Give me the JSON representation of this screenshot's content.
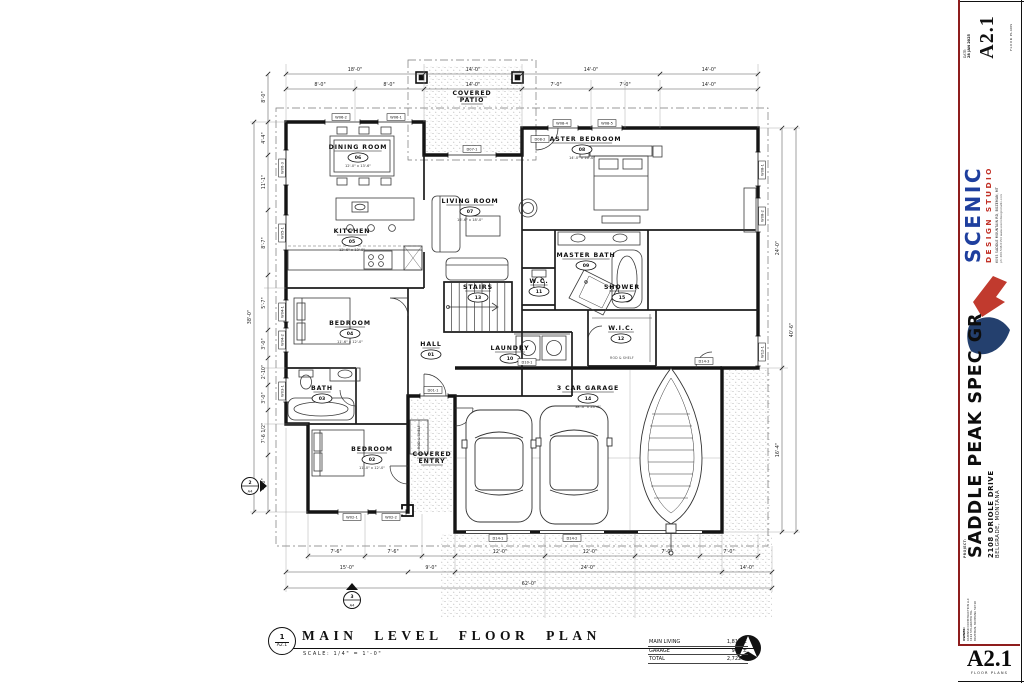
{
  "sheet": {
    "date_label": "DATE:",
    "date": "28 JAN 2025",
    "number": "A2.1",
    "number_caption": "FLOOR PLANS",
    "studio": {
      "name": "SCENIC",
      "tagline": "DESIGN STUDIO",
      "address": "6093 SADDLE MOUNTAIN RD, BOZEMAN, MT",
      "contact": "ph: 406.548.6154   www.scenicdesignstudio.com"
    },
    "project_label": "PROJECT:",
    "project": "SADDLE PEAK SPEC GR",
    "address": "2108 ORIOLE DRIVE",
    "city": "BELGRADE, MONTANA",
    "owner_label": "OWNER:",
    "owner_lines": [
      "KAMINSKI CONSTRUCTION LLC",
      "1114 STILLWATER TRL",
      "BOZEMAN, MONTANA 59718"
    ]
  },
  "title": {
    "detail_number": "1",
    "detail_sheet": "A2.1",
    "name": "MAIN LEVEL FLOOR PLAN",
    "scale": "SCALE:   1/4\" = 1'-0\"",
    "areas": [
      {
        "label": "MAIN LIVING",
        "value": "1,818 ±"
      },
      {
        "label": "GARAGE",
        "value": "904 ±"
      },
      {
        "label": "TOTAL",
        "value": "2,722 ±"
      }
    ]
  },
  "plan": {
    "rooms": [
      {
        "name": "DINING ROOM",
        "tag": "06",
        "dim": "12'-0\" x 13'-6\"",
        "x": 358,
        "y": 149
      },
      {
        "name": "KITCHEN",
        "tag": "05",
        "dim": "12'-6\" x 13'-0\"",
        "x": 352,
        "y": 233
      },
      {
        "name": "LIVING ROOM",
        "tag": "07",
        "dim": "16'-6\" x 18'-0\"",
        "x": 470,
        "y": 203
      },
      {
        "name": "MASTER BEDROOM",
        "tag": "08",
        "dim": "14'-0\" x 16'-0\"",
        "x": 582,
        "y": 141
      },
      {
        "name": "MASTER BATH",
        "tag": "09",
        "dim": "",
        "x": 586,
        "y": 257
      },
      {
        "name": "SHOWER",
        "tag": "15",
        "dim": "",
        "x": 622,
        "y": 289
      },
      {
        "name": "W.C.",
        "tag": "11",
        "dim": "",
        "x": 539,
        "y": 283
      },
      {
        "name": "STAIRS",
        "tag": "13",
        "dim": "",
        "x": 478,
        "y": 289
      },
      {
        "name": "LAUNDRY",
        "tag": "10",
        "dim": "",
        "x": 510,
        "y": 350
      },
      {
        "name": "W.I.C.",
        "tag": "12",
        "dim": "",
        "x": 621,
        "y": 330
      },
      {
        "name": "HALL",
        "tag": "01",
        "dim": "",
        "x": 431,
        "y": 346
      },
      {
        "name": "BEDROOM",
        "tag": "04",
        "dim": "11'-6\" x 12'-0\"",
        "x": 350,
        "y": 325
      },
      {
        "name": "BATH",
        "tag": "03",
        "dim": "",
        "x": 322,
        "y": 390
      },
      {
        "name": "BEDROOM",
        "tag": "02",
        "dim": "11'-0\" x 12'-0\"",
        "x": 372,
        "y": 451
      },
      {
        "name": "3 CAR GARAGE",
        "tag": "14",
        "dim": "38'-0\" x 24'-0\"",
        "x": 588,
        "y": 390
      },
      {
        "name": "COVERED|PATIO",
        "tag": "",
        "dim": "",
        "x": 472,
        "y": 95
      },
      {
        "name": "COVERED|ENTRY",
        "tag": "",
        "dim": "",
        "x": 432,
        "y": 456
      }
    ],
    "wd_tags": [
      {
        "l": "W06-2",
        "x": 341,
        "y": 117,
        "r": 0
      },
      {
        "l": "W06-1",
        "x": 396,
        "y": 117,
        "r": 0
      },
      {
        "l": "D07-1",
        "x": 472,
        "y": 149,
        "r": 0
      },
      {
        "l": "D08-2",
        "x": 540,
        "y": 139,
        "r": 0
      },
      {
        "l": "W08-4",
        "x": 562,
        "y": 123,
        "r": 0
      },
      {
        "l": "W08-5",
        "x": 607,
        "y": 123,
        "r": 0
      },
      {
        "l": "W08-1",
        "x": 762,
        "y": 170,
        "r": -90
      },
      {
        "l": "W08-2",
        "x": 762,
        "y": 216,
        "r": -90
      },
      {
        "l": "W06-3",
        "x": 282,
        "y": 168,
        "r": -90
      },
      {
        "l": "W05-1",
        "x": 282,
        "y": 233,
        "r": -90
      },
      {
        "l": "W04-1",
        "x": 282,
        "y": 312,
        "r": -90
      },
      {
        "l": "W04-2",
        "x": 282,
        "y": 340,
        "r": -90
      },
      {
        "l": "W03-1",
        "x": 282,
        "y": 391,
        "r": -90
      },
      {
        "l": "W02-1",
        "x": 352,
        "y": 517,
        "r": 0
      },
      {
        "l": "W02-2",
        "x": 391,
        "y": 517,
        "r": 0
      },
      {
        "l": "D01-1",
        "x": 433,
        "y": 390,
        "r": 0
      },
      {
        "l": "D10-1",
        "x": 527,
        "y": 362,
        "r": 0
      },
      {
        "l": "D14-3",
        "x": 704,
        "y": 361,
        "r": 0
      },
      {
        "l": "D14-1",
        "x": 498,
        "y": 538,
        "r": 0
      },
      {
        "l": "D14-2",
        "x": 572,
        "y": 538,
        "r": 0
      },
      {
        "l": "W12-1",
        "x": 762,
        "y": 352,
        "r": -90
      }
    ],
    "dims": [
      {
        "t": "18'-0\"",
        "x": 355,
        "y": 71,
        "r": 0
      },
      {
        "t": "14'-0\"",
        "x": 473,
        "y": 71,
        "r": 0
      },
      {
        "t": "14'-0\"",
        "x": 591,
        "y": 71,
        "r": 0
      },
      {
        "t": "14'-0\"",
        "x": 709,
        "y": 71,
        "r": 0
      },
      {
        "t": "8'-0\"",
        "x": 320,
        "y": 86,
        "r": 0
      },
      {
        "t": "8'-0\"",
        "x": 389,
        "y": 86,
        "r": 0
      },
      {
        "t": "14'-0\"",
        "x": 473,
        "y": 86,
        "r": 0
      },
      {
        "t": "7'-0\"",
        "x": 556,
        "y": 86,
        "r": 0
      },
      {
        "t": "7'-0\"",
        "x": 625,
        "y": 86,
        "r": 0
      },
      {
        "t": "14'-0\"",
        "x": 709,
        "y": 86,
        "r": 0
      },
      {
        "t": "8'-0\"",
        "x": 265,
        "y": 97,
        "r": -90
      },
      {
        "t": "4'-4\"",
        "x": 265,
        "y": 138,
        "r": -90
      },
      {
        "t": "11'-1\"",
        "x": 265,
        "y": 182,
        "r": -90
      },
      {
        "t": "8'-7\"",
        "x": 265,
        "y": 243,
        "r": -90
      },
      {
        "t": "5'-7\"",
        "x": 265,
        "y": 303,
        "r": -90
      },
      {
        "t": "3'-0\"",
        "x": 265,
        "y": 344,
        "r": -90
      },
      {
        "t": "2'-10\"",
        "x": 265,
        "y": 372,
        "r": -90
      },
      {
        "t": "3'-0\"",
        "x": 265,
        "y": 398,
        "r": -90
      },
      {
        "t": "7'-6 1/2\"",
        "x": 265,
        "y": 433,
        "r": -90
      },
      {
        "t": "4'-0\"",
        "x": 265,
        "y": 484,
        "r": -90
      },
      {
        "t": "38'-0\"",
        "x": 251,
        "y": 317,
        "r": -90
      },
      {
        "t": "24'-0\"",
        "x": 779,
        "y": 248,
        "r": -90
      },
      {
        "t": "16'-4\"",
        "x": 779,
        "y": 450,
        "r": -90
      },
      {
        "t": "40'-6\"",
        "x": 793,
        "y": 330,
        "r": -90
      },
      {
        "t": "7'-6\"",
        "x": 336,
        "y": 553,
        "r": 0
      },
      {
        "t": "7'-6\"",
        "x": 393,
        "y": 553,
        "r": 0
      },
      {
        "t": "12'-0\"",
        "x": 500,
        "y": 553,
        "r": 0
      },
      {
        "t": "12'-0\"",
        "x": 590,
        "y": 553,
        "r": 0
      },
      {
        "t": "7'-0\"",
        "x": 667,
        "y": 553,
        "r": 0
      },
      {
        "t": "7'-0\"",
        "x": 729,
        "y": 553,
        "r": 0
      },
      {
        "t": "15'-0\"",
        "x": 347,
        "y": 569,
        "r": 0
      },
      {
        "t": "9'-0\"",
        "x": 431,
        "y": 569,
        "r": 0
      },
      {
        "t": "24'-0\"",
        "x": 588,
        "y": 569,
        "r": 0
      },
      {
        "t": "14'-0\"",
        "x": 747,
        "y": 569,
        "r": 0
      },
      {
        "t": "62'-0\"",
        "x": 529,
        "y": 585,
        "r": 0
      }
    ],
    "notes": [
      {
        "t": "ROD & SHELF",
        "x": 622,
        "y": 359,
        "r": 0
      },
      {
        "t": "ROD & SHELF",
        "x": 420,
        "y": 437,
        "r": -90
      }
    ],
    "section_markers": [
      {
        "num": "2",
        "sheet": "A4",
        "x": 250,
        "y": 486,
        "dir": "right"
      },
      {
        "num": "3",
        "sheet": "A4",
        "x": 352,
        "y": 600,
        "dir": "up"
      }
    ]
  }
}
